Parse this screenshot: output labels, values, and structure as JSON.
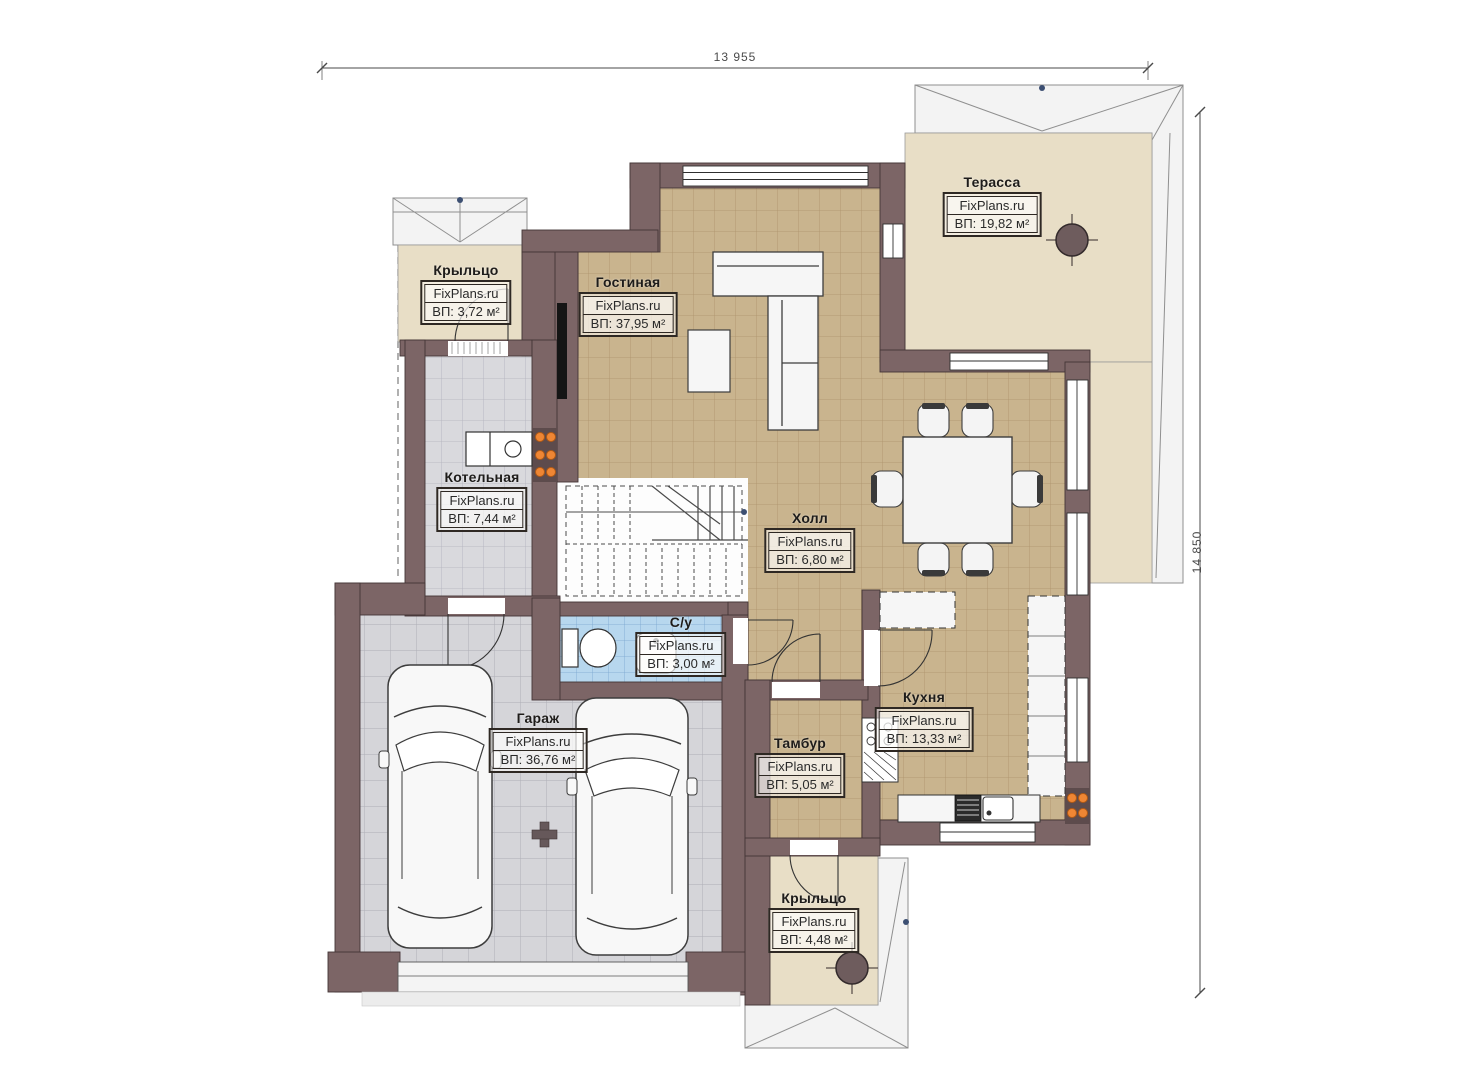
{
  "plan": {
    "watermark": "FixPlans.ru",
    "dimensions": {
      "top": "13 955",
      "right": "14 850"
    },
    "rooms": [
      {
        "id": "terrace",
        "name": "Терасса",
        "area": "ВП: 19,82 м²"
      },
      {
        "id": "living",
        "name": "Гостиная",
        "area": "ВП: 37,95 м²"
      },
      {
        "id": "porch_top",
        "name": "Крыльцо",
        "area": "ВП: 3,72 м²"
      },
      {
        "id": "boiler",
        "name": "Котельная",
        "area": "ВП: 7,44 м²"
      },
      {
        "id": "hall",
        "name": "Холл",
        "area": "ВП: 6,80 м²"
      },
      {
        "id": "bath",
        "name": "С/у",
        "area": "ВП: 3,00 м²"
      },
      {
        "id": "garage",
        "name": "Гараж",
        "area": "ВП: 36,76 м²"
      },
      {
        "id": "kitchen",
        "name": "Кухня",
        "area": "ВП: 13,33 м²"
      },
      {
        "id": "tambour",
        "name": "Тамбур",
        "area": "ВП: 5,05 м²"
      },
      {
        "id": "porch_bottom",
        "name": "Крыльцо",
        "area": "ВП: 4,48 м²"
      }
    ],
    "colors": {
      "wall": "#7c6566",
      "floor_tan": "#c9b48e",
      "floor_gray": "#d9d9dd",
      "floor_garage": "#d5d5d9",
      "floor_bath": "#b7d7ee",
      "floor_porch": "#e8dec6",
      "radiator": "#ef8634"
    }
  }
}
